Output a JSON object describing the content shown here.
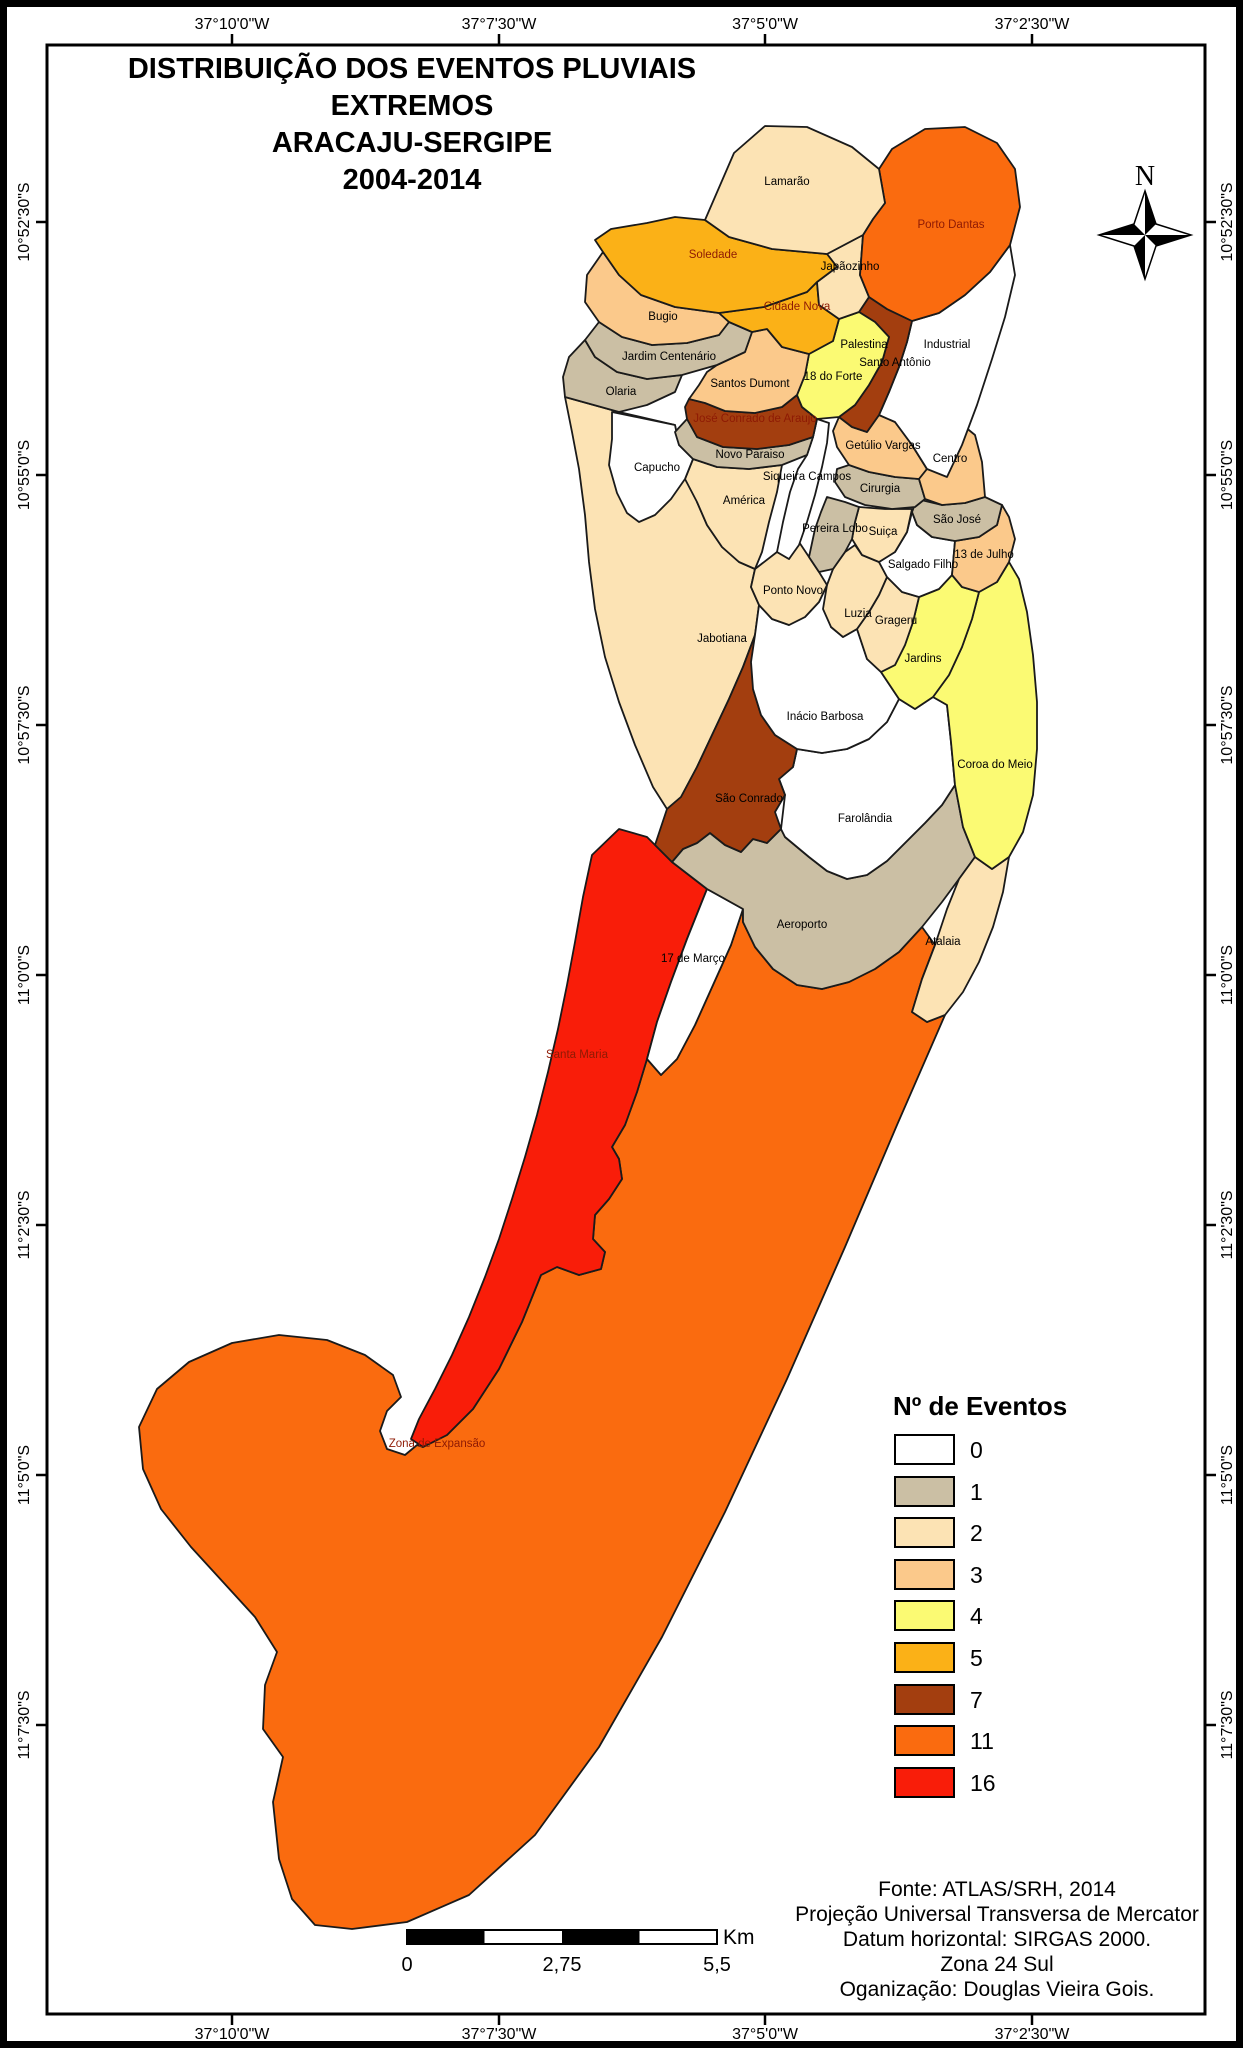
{
  "title": {
    "line1": "DISTRIBUIÇÃO DOS EVENTOS PLUVIAIS EXTREMOS",
    "line2": "ARACAJU-SERGIPE",
    "line3": "2004-2014"
  },
  "compass": {
    "north_label": "N"
  },
  "coordinates": {
    "top": [
      "37°10'0\"W",
      "37°7'30\"W",
      "37°5'0\"W",
      "37°2'30\"W"
    ],
    "bottom": [
      "37°10'0\"W",
      "37°7'30\"W",
      "37°5'0\"W",
      "37°2'30\"W"
    ],
    "left": [
      "10°52'30\"S",
      "10°55'0\"S",
      "10°57'30\"S",
      "11°0'0\"S",
      "11°2'30\"S",
      "11°5'0\"S",
      "11°7'30\"S"
    ],
    "right": [
      "10°52'30\"S",
      "10°55'0\"S",
      "10°57'30\"S",
      "11°0'0\"S",
      "11°2'30\"S",
      "11°5'0\"S",
      "11°7'30\"S"
    ]
  },
  "legend": {
    "title": "Nº de Eventos",
    "items": [
      {
        "value": "0",
        "color": "#FFFFFF"
      },
      {
        "value": "1",
        "color": "#CBBFA4"
      },
      {
        "value": "2",
        "color": "#FCE3B4"
      },
      {
        "value": "3",
        "color": "#FBC98B"
      },
      {
        "value": "4",
        "color": "#FBFA73"
      },
      {
        "value": "5",
        "color": "#FBB117"
      },
      {
        "value": "7",
        "color": "#A33E0F"
      },
      {
        "value": "11",
        "color": "#FA6B0F"
      },
      {
        "value": "16",
        "color": "#F91D09"
      }
    ]
  },
  "scale_bar": {
    "labels": [
      "0",
      "2,75",
      "5,5"
    ],
    "unit": "Km"
  },
  "credits": {
    "lines": [
      "Fonte: ATLAS/SRH, 2014",
      "Projeção Universal Transversa de Mercator",
      "Datum horizontal: SIRGAS 2000.",
      "Zona 24 Sul",
      "Oganização: Douglas Vieira Gois."
    ]
  },
  "regions": [
    {
      "name": "Jabotiana",
      "events": 2,
      "color": "#FCE3B4",
      "label_color": "#000000"
    },
    {
      "name": "Zona de Expansão",
      "events": 11,
      "color": "#FA6B0F",
      "label_color": "#8E1A04"
    },
    {
      "name": "Santa Maria",
      "events": 16,
      "color": "#F91D09",
      "label_color": "#8E1A04"
    },
    {
      "name": "17 de Março",
      "events": 0,
      "color": "#FFFFFF",
      "label_color": "#000000"
    },
    {
      "name": "Aeroporto",
      "events": 1,
      "color": "#CBBFA4",
      "label_color": "#000000"
    },
    {
      "name": "Atalaia",
      "events": 2,
      "color": "#FCE3B4",
      "label_color": "#000000"
    },
    {
      "name": "Farolândia",
      "events": 0,
      "color": "#FFFFFF",
      "label_color": "#000000"
    },
    {
      "name": "São Conrado",
      "events": 7,
      "color": "#A33E0F",
      "label_color": "#000000"
    },
    {
      "name": "Inácio Barbosa",
      "events": 0,
      "color": "#FFFFFF",
      "label_color": "#000000"
    },
    {
      "name": "Coroa do Meio",
      "events": 4,
      "color": "#FBFA73",
      "label_color": "#000000"
    },
    {
      "name": "Jardins",
      "events": 4,
      "color": "#FBFA73",
      "label_color": "#000000"
    },
    {
      "name": "Grageru",
      "events": 2,
      "color": "#FCE3B4",
      "label_color": "#000000"
    },
    {
      "name": "Luzia",
      "events": 2,
      "color": "#FCE3B4",
      "label_color": "#000000"
    },
    {
      "name": "Ponto Novo",
      "events": 2,
      "color": "#FCE3B4",
      "label_color": "#000000"
    },
    {
      "name": "Salgado Filho",
      "events": 0,
      "color": "#FFFFFF",
      "label_color": "#000000"
    },
    {
      "name": "13 de Julho",
      "events": 3,
      "color": "#FBC98B",
      "label_color": "#000000"
    },
    {
      "name": "São José",
      "events": 1,
      "color": "#CBBFA4",
      "label_color": "#000000"
    },
    {
      "name": "Suiça",
      "events": 2,
      "color": "#FCE3B4",
      "label_color": "#000000"
    },
    {
      "name": "Pereira Lobo",
      "events": 1,
      "color": "#CBBFA4",
      "label_color": "#000000"
    },
    {
      "name": "Cirurgia",
      "events": 1,
      "color": "#CBBFA4",
      "label_color": "#000000"
    },
    {
      "name": "América",
      "events": 2,
      "color": "#FCE3B4",
      "label_color": "#000000"
    },
    {
      "name": "Capucho",
      "events": 0,
      "color": "#FFFFFF",
      "label_color": "#000000"
    },
    {
      "name": "Siqueira Campos",
      "events": 0,
      "color": "#FFFFFF",
      "label_color": "#000000"
    },
    {
      "name": "Novo Paraiso",
      "events": 1,
      "color": "#CBBFA4",
      "label_color": "#000000"
    },
    {
      "name": "José Conrado de Araujo",
      "events": 7,
      "color": "#A33E0F",
      "label_color": "#8E1A04"
    },
    {
      "name": "Getúlio Vargas",
      "events": 3,
      "color": "#FBC98B",
      "label_color": "#000000"
    },
    {
      "name": "Centro",
      "events": 3,
      "color": "#FBC98B",
      "label_color": "#000000"
    },
    {
      "name": "Industrial",
      "events": 0,
      "color": "#FFFFFF",
      "label_color": "#000000"
    },
    {
      "name": "Santo Antônio",
      "events": 7,
      "color": "#A33E0F",
      "label_color": "#000000"
    },
    {
      "name": "Palestina",
      "events": 0,
      "color": "#FFFFFF",
      "label_color": "#000000"
    },
    {
      "name": "18 do Forte",
      "events": 4,
      "color": "#FBFA73",
      "label_color": "#000000"
    },
    {
      "name": "Santos Dumont",
      "events": 3,
      "color": "#FBC98B",
      "label_color": "#000000"
    },
    {
      "name": "Olaria",
      "events": 1,
      "color": "#CBBFA4",
      "label_color": "#000000"
    },
    {
      "name": "Jardim Centenário",
      "events": 1,
      "color": "#CBBFA4",
      "label_color": "#000000"
    },
    {
      "name": "Bugio",
      "events": 3,
      "color": "#FBC98B",
      "label_color": "#000000"
    },
    {
      "name": "Cidade Nova",
      "events": 5,
      "color": "#FBB117",
      "label_color": "#8E1A04"
    },
    {
      "name": "Japãozinho",
      "events": 2,
      "color": "#FCE3B4",
      "label_color": "#000000"
    },
    {
      "name": "Soledade",
      "events": 5,
      "color": "#FBB117",
      "label_color": "#8E1A04"
    },
    {
      "name": "Porto Dantas",
      "events": 11,
      "color": "#FA6B0F",
      "label_color": "#8E1A04"
    },
    {
      "name": "Lamarão",
      "events": 2,
      "color": "#FCE3B4",
      "label_color": "#000000"
    }
  ]
}
